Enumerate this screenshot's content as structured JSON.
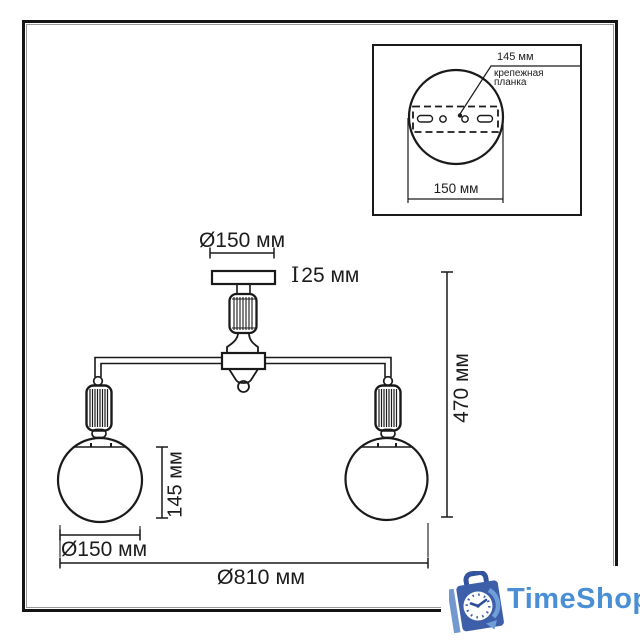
{
  "diagram": {
    "stroke": "#1a1a1a",
    "labels": {
      "canopy_diameter": "Ø150 мм",
      "canopy_height_mark": "I",
      "canopy_height": "25 мм",
      "total_height": "470 мм",
      "globe_height": "145 мм",
      "globe_diameter": "Ø150 мм",
      "total_width": "Ø810 мм"
    },
    "inset": {
      "bracket_width": "145 мм",
      "bracket_name_line1": "крепежная",
      "bracket_name_line2": "планка",
      "base_diameter": "150 мм"
    }
  },
  "watermark": {
    "brand": "TimeShop",
    "text_color": "#4a8fd6",
    "bag_color": "#3d5fa9",
    "handle_color": "#34539f",
    "accent_color": "#6f9ed9"
  }
}
